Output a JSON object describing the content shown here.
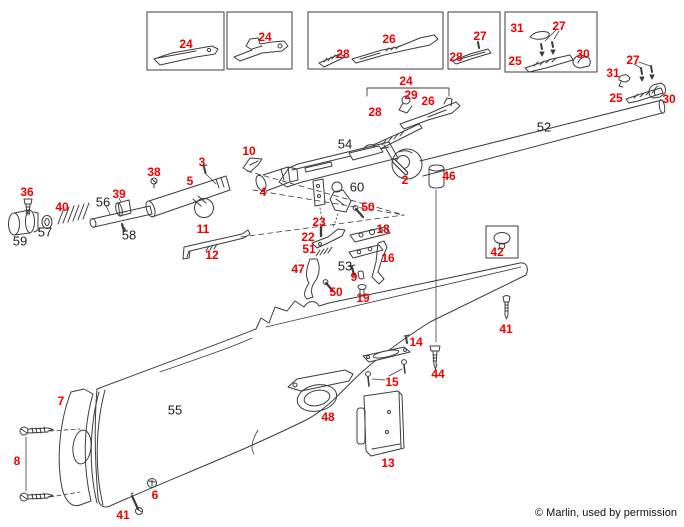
{
  "page": {
    "title": "Rifle exploded parts diagram",
    "copyright": "© Marlin, used by permission",
    "background": "#ffffff"
  },
  "colors": {
    "red": "#ee0000",
    "black": "#1d1d1d",
    "line": "#3c3c3c"
  },
  "diagram": {
    "type": "exploded-parts-diagram",
    "labels": [
      {
        "part": "24",
        "x": 186,
        "y": 44,
        "color": "red"
      },
      {
        "part": "24",
        "x": 265,
        "y": 37,
        "color": "red"
      },
      {
        "part": "28",
        "x": 343,
        "y": 54,
        "color": "red"
      },
      {
        "part": "26",
        "x": 389,
        "y": 39,
        "color": "red"
      },
      {
        "part": "27",
        "x": 480,
        "y": 36,
        "color": "red"
      },
      {
        "part": "28",
        "x": 456,
        "y": 57,
        "color": "red"
      },
      {
        "part": "31",
        "x": 517,
        "y": 28,
        "color": "red"
      },
      {
        "part": "27",
        "x": 559,
        "y": 26,
        "color": "red"
      },
      {
        "part": "25",
        "x": 515,
        "y": 61,
        "color": "red"
      },
      {
        "part": "30",
        "x": 583,
        "y": 54,
        "color": "red"
      },
      {
        "part": "27",
        "x": 633,
        "y": 60,
        "color": "red"
      },
      {
        "part": "31",
        "x": 613,
        "y": 73,
        "color": "red"
      },
      {
        "part": "25",
        "x": 616,
        "y": 98,
        "color": "red"
      },
      {
        "part": "30",
        "x": 669,
        "y": 99,
        "color": "red"
      },
      {
        "part": "24",
        "x": 406,
        "y": 81,
        "color": "red"
      },
      {
        "part": "29",
        "x": 411,
        "y": 95,
        "color": "red"
      },
      {
        "part": "26",
        "x": 428,
        "y": 101,
        "color": "red"
      },
      {
        "part": "28",
        "x": 375,
        "y": 112,
        "color": "red"
      },
      {
        "part": "52",
        "x": 544,
        "y": 127,
        "color": "black"
      },
      {
        "part": "54",
        "x": 345,
        "y": 144,
        "color": "black"
      },
      {
        "part": "2",
        "x": 405,
        "y": 180,
        "color": "red"
      },
      {
        "part": "46",
        "x": 449,
        "y": 176,
        "color": "red"
      },
      {
        "part": "3",
        "x": 202,
        "y": 162,
        "color": "red"
      },
      {
        "part": "10",
        "x": 249,
        "y": 151,
        "color": "red"
      },
      {
        "part": "38",
        "x": 154,
        "y": 172,
        "color": "red"
      },
      {
        "part": "5",
        "x": 190,
        "y": 181,
        "color": "red"
      },
      {
        "part": "4",
        "x": 263,
        "y": 192,
        "color": "red"
      },
      {
        "part": "36",
        "x": 27,
        "y": 192,
        "color": "red"
      },
      {
        "part": "40",
        "x": 62,
        "y": 207,
        "color": "red"
      },
      {
        "part": "59",
        "x": 20,
        "y": 241,
        "color": "black"
      },
      {
        "part": "57",
        "x": 45,
        "y": 232,
        "color": "black"
      },
      {
        "part": "56",
        "x": 103,
        "y": 202,
        "color": "black"
      },
      {
        "part": "39",
        "x": 119,
        "y": 194,
        "color": "red"
      },
      {
        "part": "58",
        "x": 129,
        "y": 235,
        "color": "black"
      },
      {
        "part": "11",
        "x": 203,
        "y": 229,
        "color": "red"
      },
      {
        "part": "12",
        "x": 212,
        "y": 255,
        "color": "red"
      },
      {
        "part": "60",
        "x": 357,
        "y": 187,
        "color": "black"
      },
      {
        "part": "50",
        "x": 368,
        "y": 207,
        "color": "red"
      },
      {
        "part": "23",
        "x": 319,
        "y": 222,
        "color": "red"
      },
      {
        "part": "22",
        "x": 308,
        "y": 237,
        "color": "red"
      },
      {
        "part": "51",
        "x": 309,
        "y": 249,
        "color": "red"
      },
      {
        "part": "18",
        "x": 383,
        "y": 229,
        "color": "red"
      },
      {
        "part": "16",
        "x": 388,
        "y": 258,
        "color": "red"
      },
      {
        "part": "47",
        "x": 298,
        "y": 269,
        "color": "red"
      },
      {
        "part": "50",
        "x": 336,
        "y": 292,
        "color": "red"
      },
      {
        "part": "53",
        "x": 345,
        "y": 266,
        "color": "black"
      },
      {
        "part": "9",
        "x": 354,
        "y": 277,
        "color": "red"
      },
      {
        "part": "19",
        "x": 363,
        "y": 298,
        "color": "red"
      },
      {
        "part": "42",
        "x": 497,
        "y": 252,
        "color": "red"
      },
      {
        "part": "41",
        "x": 506,
        "y": 329,
        "color": "red"
      },
      {
        "part": "44",
        "x": 438,
        "y": 374,
        "color": "red"
      },
      {
        "part": "14",
        "x": 416,
        "y": 342,
        "color": "red"
      },
      {
        "part": "15",
        "x": 392,
        "y": 382,
        "color": "red"
      },
      {
        "part": "48",
        "x": 328,
        "y": 417,
        "color": "red"
      },
      {
        "part": "13",
        "x": 388,
        "y": 463,
        "color": "red"
      },
      {
        "part": "55",
        "x": 175,
        "y": 410,
        "color": "black"
      },
      {
        "part": "7",
        "x": 61,
        "y": 401,
        "color": "red"
      },
      {
        "part": "8",
        "x": 17,
        "y": 461,
        "color": "red"
      },
      {
        "part": "6",
        "x": 155,
        "y": 495,
        "color": "red"
      },
      {
        "part": "41",
        "x": 123,
        "y": 515,
        "color": "red"
      }
    ]
  }
}
